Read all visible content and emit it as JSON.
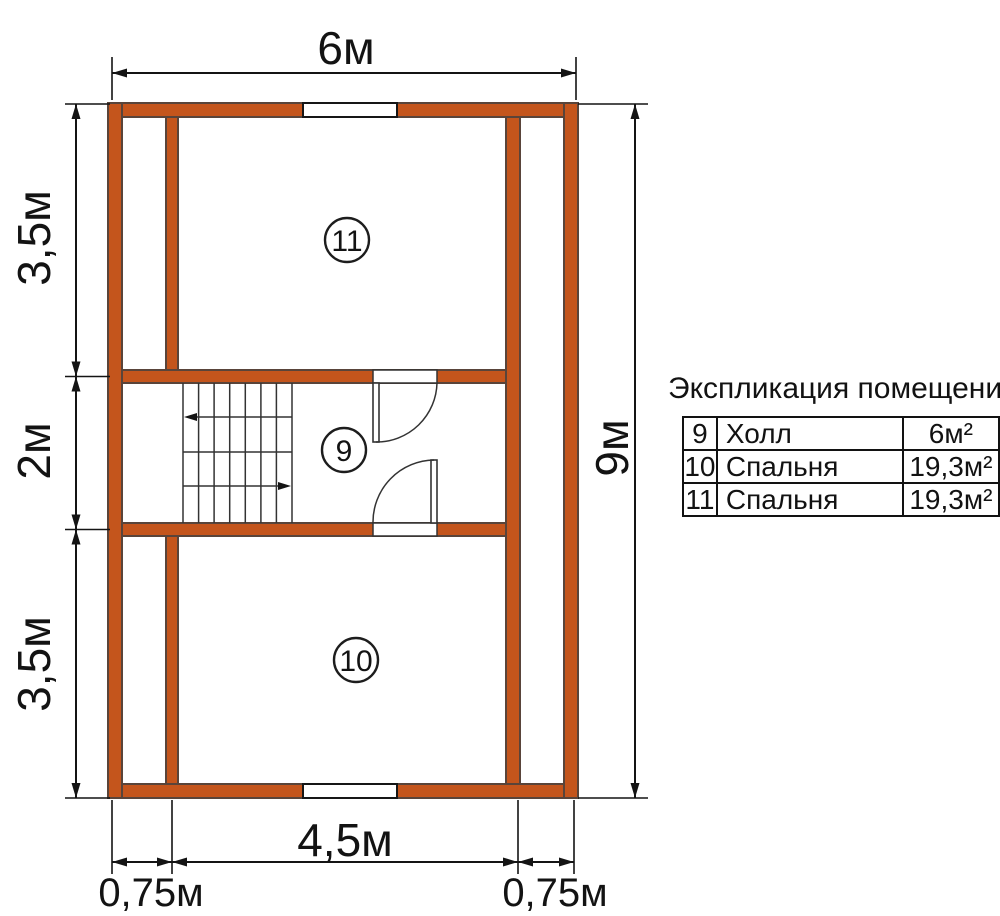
{
  "colors": {
    "wall_fill": "#c4551c",
    "wall_edge": "#59443a",
    "line_color": "#141414"
  },
  "dimensions": {
    "top_width": "6м",
    "right_height": "9м",
    "left_top": "3,5м",
    "left_middle": "2м",
    "left_bottom": "3,5м",
    "bottom_center": "4,5м",
    "bottom_left": "0,75м",
    "bottom_right": "0,75м"
  },
  "room_markers": {
    "top": "11",
    "middle": "9",
    "bottom": "10"
  },
  "legend": {
    "title": "Экспликация помещений",
    "rows": [
      {
        "num": "9",
        "name": "Холл",
        "area": "6м²"
      },
      {
        "num": "10",
        "name": "Спальня",
        "area": "19,3м²"
      },
      {
        "num": "11",
        "name": "Спальня",
        "area": "19,3м²"
      }
    ]
  }
}
